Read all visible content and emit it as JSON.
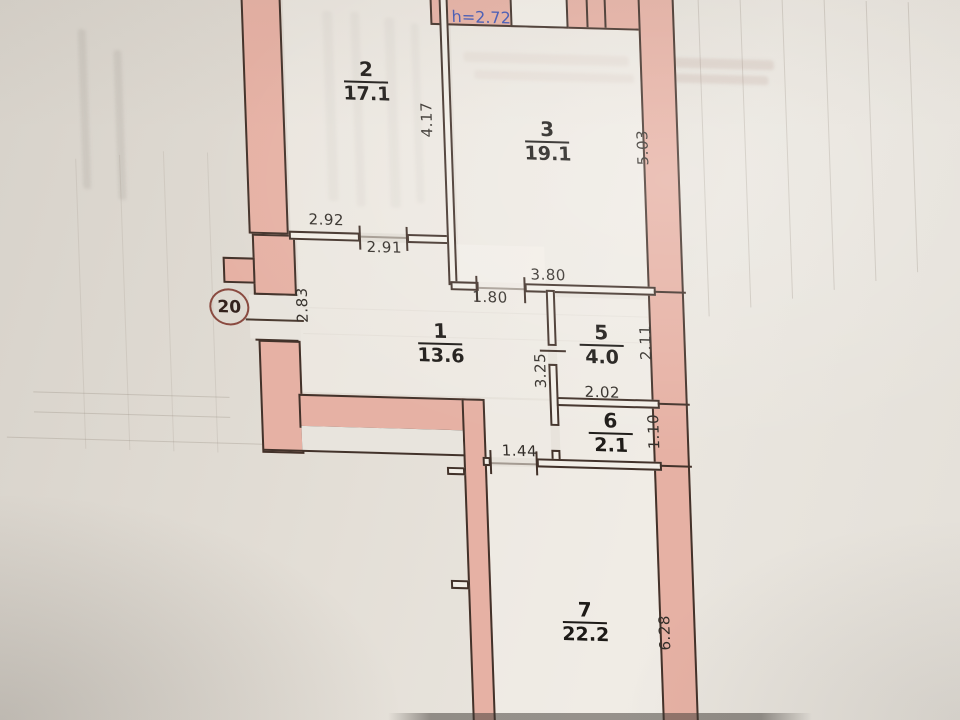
{
  "plan": {
    "height_note": "h=2.72",
    "apartment_number": "20",
    "rooms": {
      "r1": {
        "number": "1",
        "area": "13.6"
      },
      "r2": {
        "number": "2",
        "area": "17.1"
      },
      "r3": {
        "number": "3",
        "area": "19.1"
      },
      "r5": {
        "number": "5",
        "area": "4.0"
      },
      "r6": {
        "number": "6",
        "area": "2.1"
      },
      "r7": {
        "number": "7",
        "area": "22.2"
      }
    },
    "dims": {
      "d292": "2.92",
      "d291": "2.91",
      "d417": "4.17",
      "d503": "5.03",
      "d380": "3.80",
      "d180": "1.80",
      "d283": "2.83",
      "d325": "3.25",
      "d211": "2.11",
      "d202": "2.02",
      "d110": "1.10",
      "d144": "1.44",
      "d628": "6.28"
    },
    "colors": {
      "wall_fill": "#e6b1a4",
      "wall_outline": "#42322a",
      "paper": "#e4dfd8",
      "note_blue": "#4156b4",
      "badge_ring": "#8a4a40"
    }
  }
}
